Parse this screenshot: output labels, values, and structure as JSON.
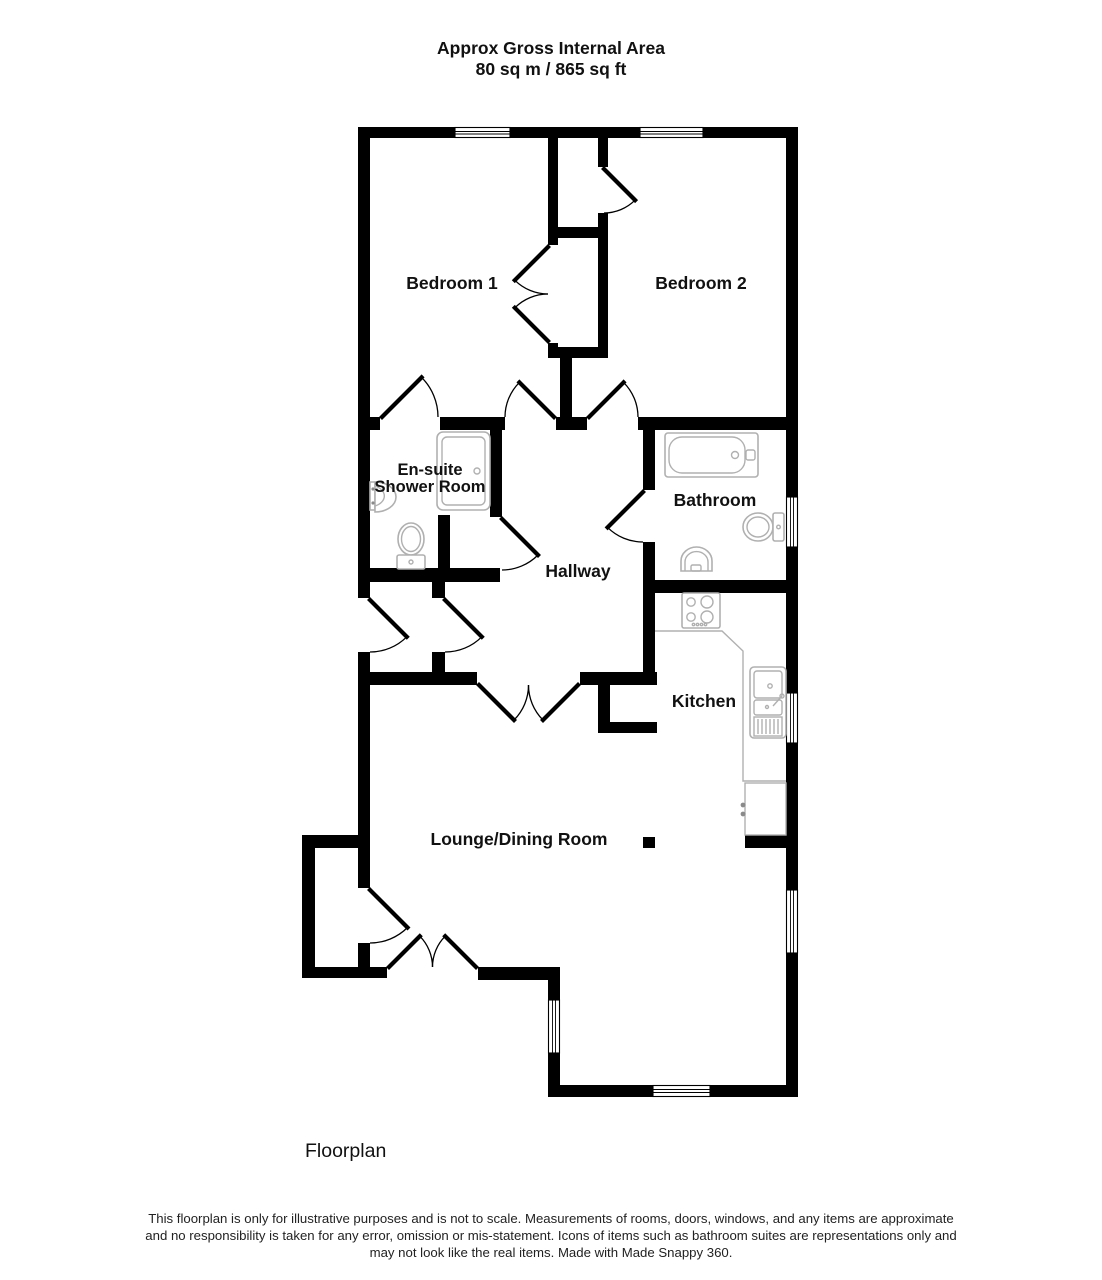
{
  "header": {
    "line1": "Approx Gross Internal Area",
    "line2": "80 sq m / 865 sq ft"
  },
  "rooms": {
    "bedroom1": "Bedroom 1",
    "bedroom2": "Bedroom 2",
    "ensuite_line1": "En-suite",
    "ensuite_line2": "Shower Room",
    "bathroom": "Bathroom",
    "hallway": "Hallway",
    "kitchen": "Kitchen",
    "lounge": "Lounge/Dining Room"
  },
  "footer": {
    "caption": "Floorplan",
    "disclaimer1": "This floorplan is only for illustrative purposes and is not to scale. Measurements of rooms, doors, windows, and any items are approximate",
    "disclaimer2": "and no responsibility is taken for any error, omission or mis-statement. Icons of items such as bathroom suites are representations only and",
    "disclaimer3": "may not look like the real items. Made with Made Snappy 360."
  },
  "colors": {
    "wall": "#000000",
    "fixture": "#b0b0b0",
    "fixture_dark": "#8a8a8a",
    "background": "#ffffff",
    "text": "#111111"
  }
}
